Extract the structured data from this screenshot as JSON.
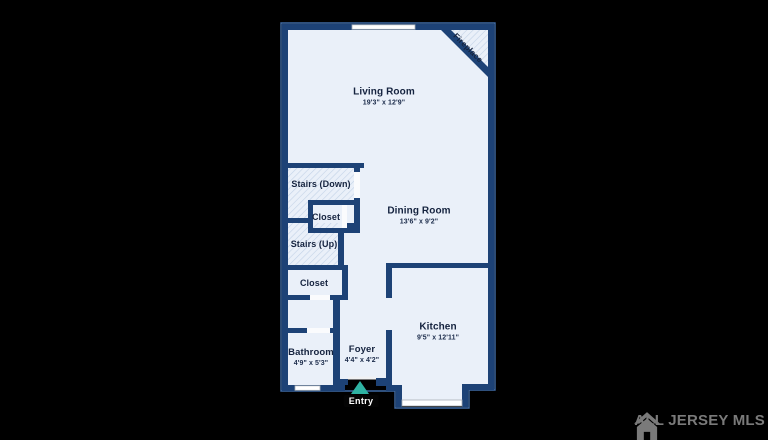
{
  "rooms": {
    "living": {
      "name": "Living Room",
      "dims": "19'3\" x 12'9\""
    },
    "dining": {
      "name": "Dining Room",
      "dims": "13'6\" x 9'2\""
    },
    "kitchen": {
      "name": "Kitchen",
      "dims": "9'5\" x 12'11\""
    },
    "bathroom": {
      "name": "Bathroom",
      "dims": "4'9\" x 5'3\""
    },
    "foyer": {
      "name": "Foyer",
      "dims": "4'4\" x 4'2\""
    },
    "stairs_down": {
      "name": "Stairs (Down)"
    },
    "stairs_up": {
      "name": "Stairs (Up)"
    },
    "closet_upper": {
      "name": "Closet"
    },
    "closet_lower": {
      "name": "Closet"
    }
  },
  "annotations": {
    "fireplace": "Fireplace",
    "entry": "Entry"
  },
  "watermark": {
    "text": "ALL JERSEY MLS"
  },
  "colors": {
    "background": "#000000",
    "wall": "#1d4276",
    "floor": "#eaf0f9",
    "hatch_line": "#c2d2e7",
    "window": "#ffffff",
    "outline": "#3f6ba6",
    "label_text": "#15233f",
    "entry_arrow": "#2fb3a3",
    "entry_badge_bg": "#040404",
    "entry_badge_text": "#ffffff",
    "watermark_gray": "#7a7a7a"
  }
}
